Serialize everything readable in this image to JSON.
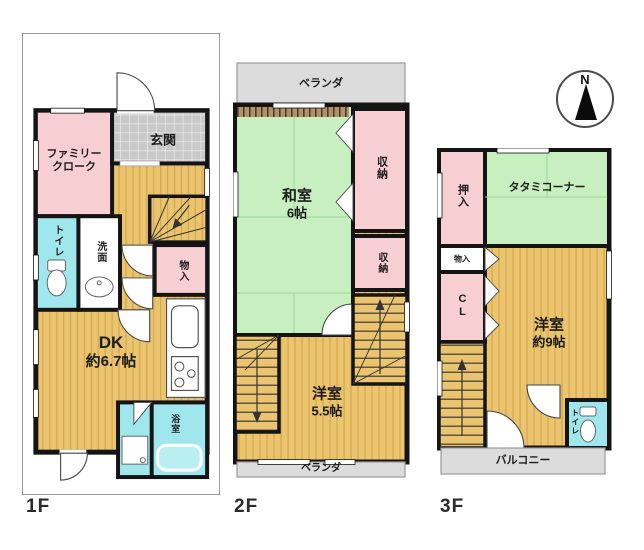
{
  "compass": {
    "north": "N"
  },
  "floors": {
    "f1": {
      "label": "1F",
      "rooms": {
        "family_cloak": {
          "line1": "ファミリー",
          "line2": "クローク"
        },
        "genkan": "玄関",
        "toilet": "トイレ",
        "washroom": "洗面",
        "storage": "物入",
        "dk": {
          "line1": "DK",
          "line2": "約6.7帖"
        },
        "bathroom": "浴室"
      }
    },
    "f2": {
      "label": "2F",
      "rooms": {
        "veranda_top": "ベランダ",
        "washitsu": {
          "line1": "和室",
          "line2": "6帖"
        },
        "closet_upper": "収納",
        "closet_lower": "収納",
        "yoshitsu": {
          "line1": "洋室",
          "line2": "5.5帖"
        },
        "veranda_bottom": "ベランダ"
      }
    },
    "f3": {
      "label": "3F",
      "rooms": {
        "oshiire": "押入",
        "tatami_corner": "タタミコーナー",
        "storage": "物入",
        "closet": "CL",
        "yoshitsu": {
          "line1": "洋室",
          "line2": "約9帖"
        },
        "toilet": "トイレ",
        "balcony": "バルコニー"
      }
    }
  },
  "colors": {
    "wood": "#eac46f",
    "tatami": "#c8efbf",
    "closet_pink": "#f7ced2",
    "water_cyan": "#9fe7ec",
    "veranda_gray": "#dcdcdc",
    "wall": "#141414"
  }
}
